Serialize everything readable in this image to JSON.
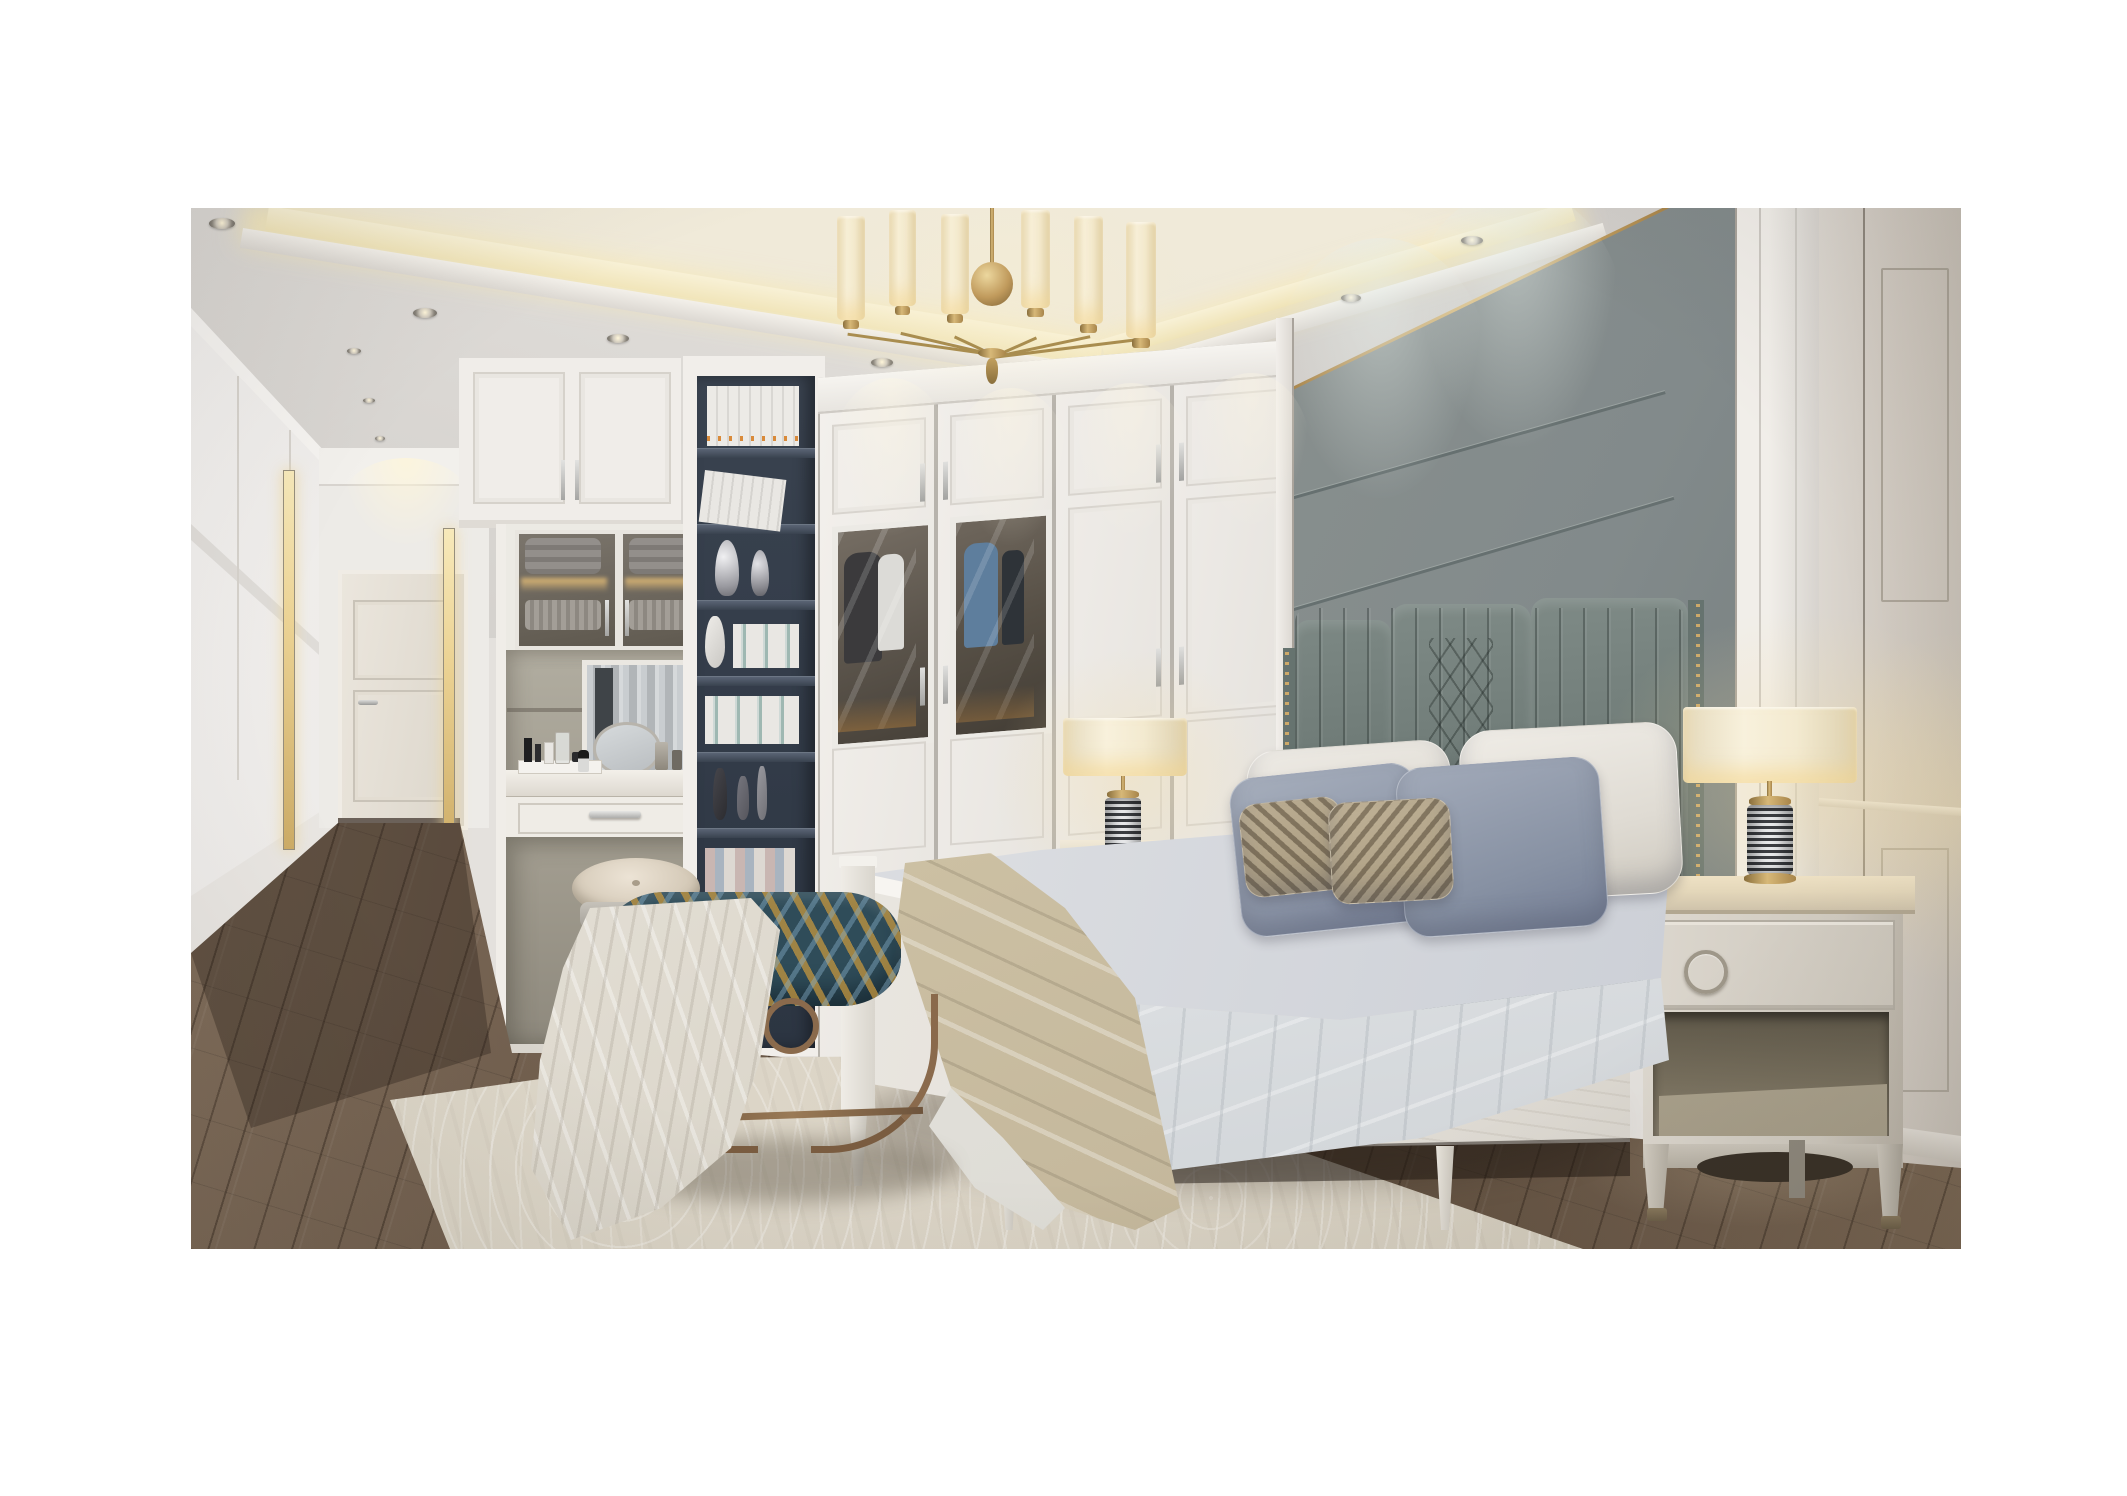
{
  "meta": {
    "domain": "Natural-Image",
    "description": "Photorealistic 3D interior render of a luxury neoclassical bedroom in white, grey and brass tones, shown as a photo centered on a white page with wide white margins.",
    "room": "bedroom"
  },
  "palette": {
    "page_margin": "#ffffff",
    "ceiling": "#e2dfdb",
    "cove_light": "#f5ecc8",
    "cornice": "#f0ede9",
    "headboard_wall_panel": "#87908d",
    "panel_gold_trim": "#c8a25e",
    "wardrobe_white": "#efece7",
    "bookshelf_navy": "#323b49",
    "headboard_leather": "#6d7975",
    "pillow_cream": "#e8e5df",
    "pillow_blue_gray": "#97a0b1",
    "pillow_striped": "#b5a78d",
    "bedding_gray": "#d3d5da",
    "duvet_white": "#eef0f1",
    "throw_beige": "#d0c5aa",
    "bed_frame_white": "#efede8",
    "nightstand_wood": "#d5d0c6",
    "lamp_shade_lit": "#f6eed4",
    "lamp_brass": "#c09a50",
    "lamp_base_stripes": "#3c3e42",
    "bench_teal": "#2f4c59",
    "bench_gold": "#c4963e",
    "bench_frame_bronze": "#8a6a4c",
    "rug_cream": "#dbd4c6",
    "floor_wood_brown": "#6b5949",
    "door_cream": "#e7e1d7",
    "mirror_glass": "#bcc0c3"
  },
  "objects": [
    {
      "name": "tray-ceiling",
      "description": "recessed tray ceiling with warm perimeter cove lighting and small round downlights"
    },
    {
      "name": "chandelier",
      "description": "brass chandelier with central sphere and six white cylindrical glass shades"
    },
    {
      "name": "headboard-wall",
      "description": "grey-green upholstered accent wall with horizontal seams and thin gold top trim"
    },
    {
      "name": "headboard",
      "description": "channel-tufted grey leather headboard with diamond quilted center and brass nailhead wings"
    },
    {
      "name": "bed",
      "description": "white wood bed with grey bedding, white duvet and beige throw"
    },
    {
      "name": "pillows",
      "description": "two cream pillows, two blue-grey pillows, two small striped pillows"
    },
    {
      "name": "bench",
      "description": "oval bench with teal and gold patterned cushion on bronze metal base, white throw draped over"
    },
    {
      "name": "stool",
      "description": "oval cream leather vanity stool"
    },
    {
      "name": "right-nightstand",
      "description": "light grey wood nightstand with ring-pull drawer, open shelf and splayed legs"
    },
    {
      "name": "left-nightstand",
      "description": "white nightstand partially hidden behind the bed"
    },
    {
      "name": "table-lamps",
      "description": "pair of lamps with striped cylindrical bases, brass fittings and lit cream drum shades"
    },
    {
      "name": "wardrobe",
      "description": "floor-to-ceiling white paneled wardrobe, two doors with smoked glass showing hanging clothes"
    },
    {
      "name": "bookshelf",
      "description": "tall navy open shelving column with white books and silver vases"
    },
    {
      "name": "dressing-nook",
      "description": "built-in vanity with mirror, cosmetics, drawer and glass display cabinets with folded linens"
    },
    {
      "name": "corridor",
      "description": "entry corridor with cream paneled door, lit niches and white wainscot walls"
    },
    {
      "name": "rug",
      "description": "large cream area rug with subtle swirl pattern"
    },
    {
      "name": "floor",
      "description": "dark brown wood plank flooring laid diagonally"
    },
    {
      "name": "right-wall",
      "description": "white classical paneled wall with pilaster beside the accent wall"
    }
  ]
}
